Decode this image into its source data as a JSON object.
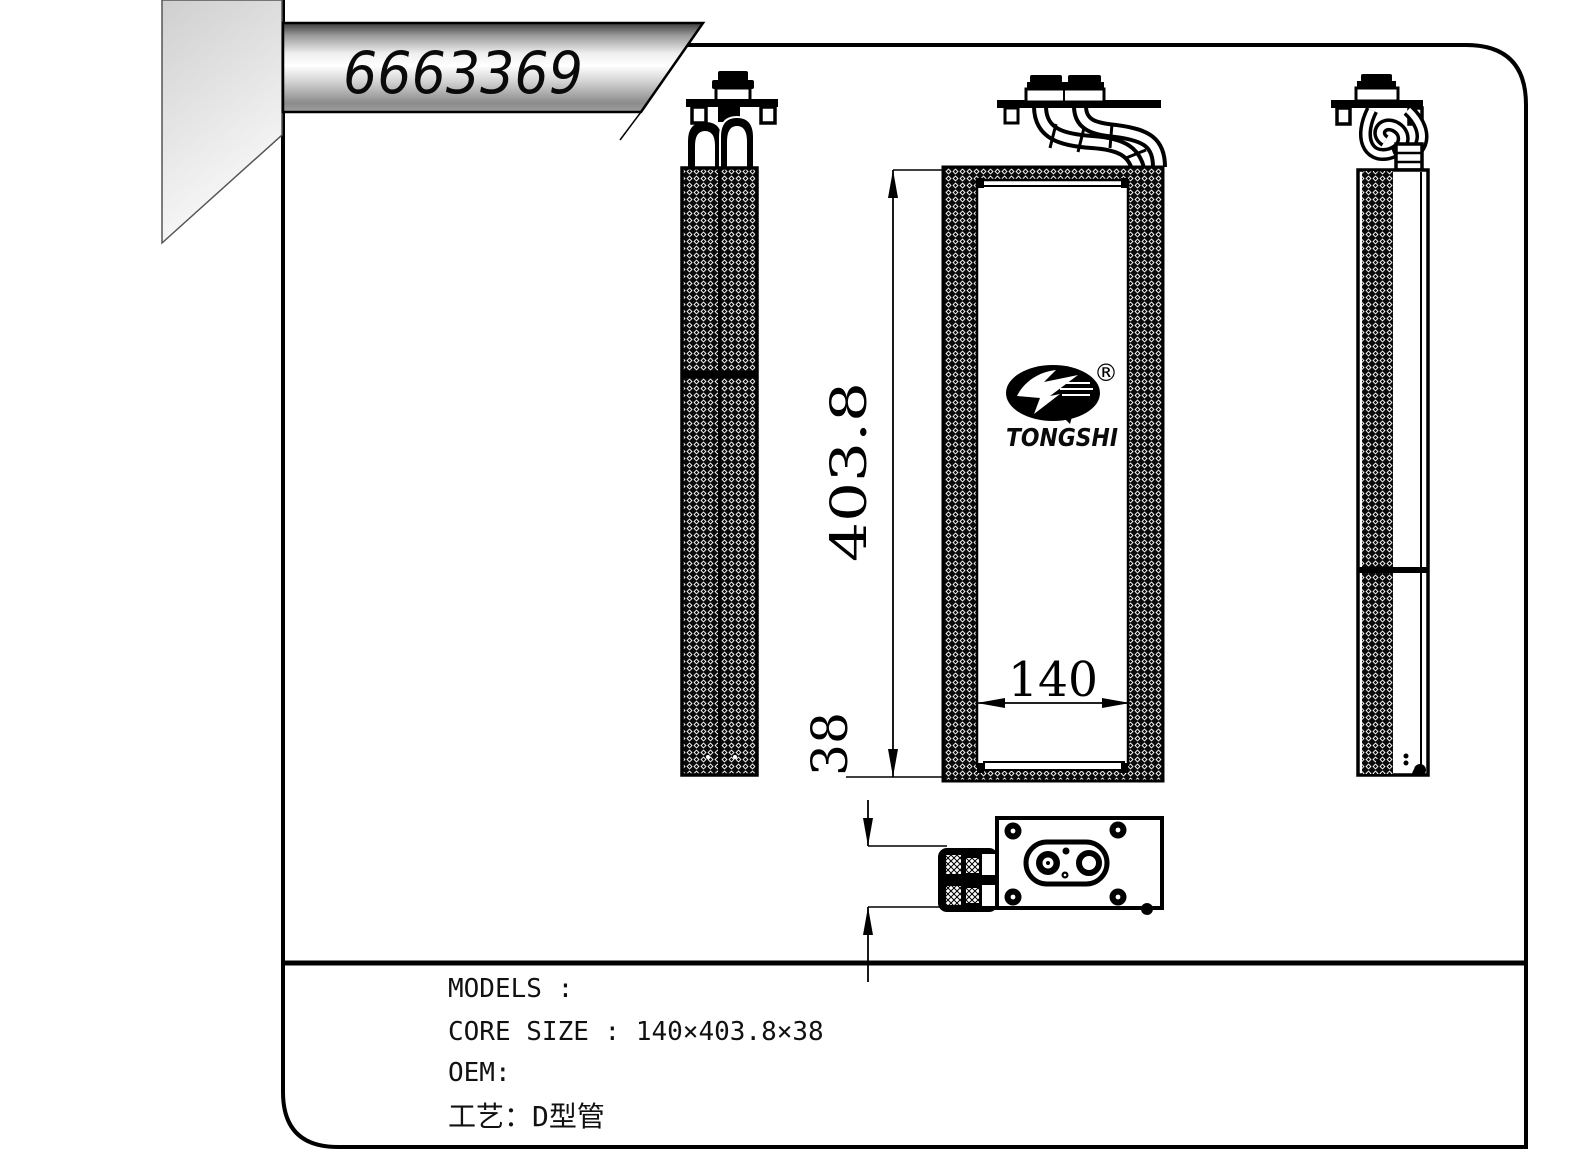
{
  "title_banner": {
    "part_number": "6663369"
  },
  "logo": {
    "brand": "TONGSHI",
    "registered_mark": "®"
  },
  "dimensions": {
    "core_height": "403.8",
    "core_width": "140",
    "core_depth": "38"
  },
  "spec_panel": {
    "models": "MODELS :",
    "core_size": "CORE SIZE : 140×403.8×38",
    "oem": "OEM:",
    "process": "工艺：D型管"
  },
  "colors": {
    "ink": "#000000",
    "paper": "#ffffff",
    "banner_dark": "#4a4a4a",
    "banner_light": "#f7f7f7",
    "fold_gray": "#d6d6d6"
  }
}
